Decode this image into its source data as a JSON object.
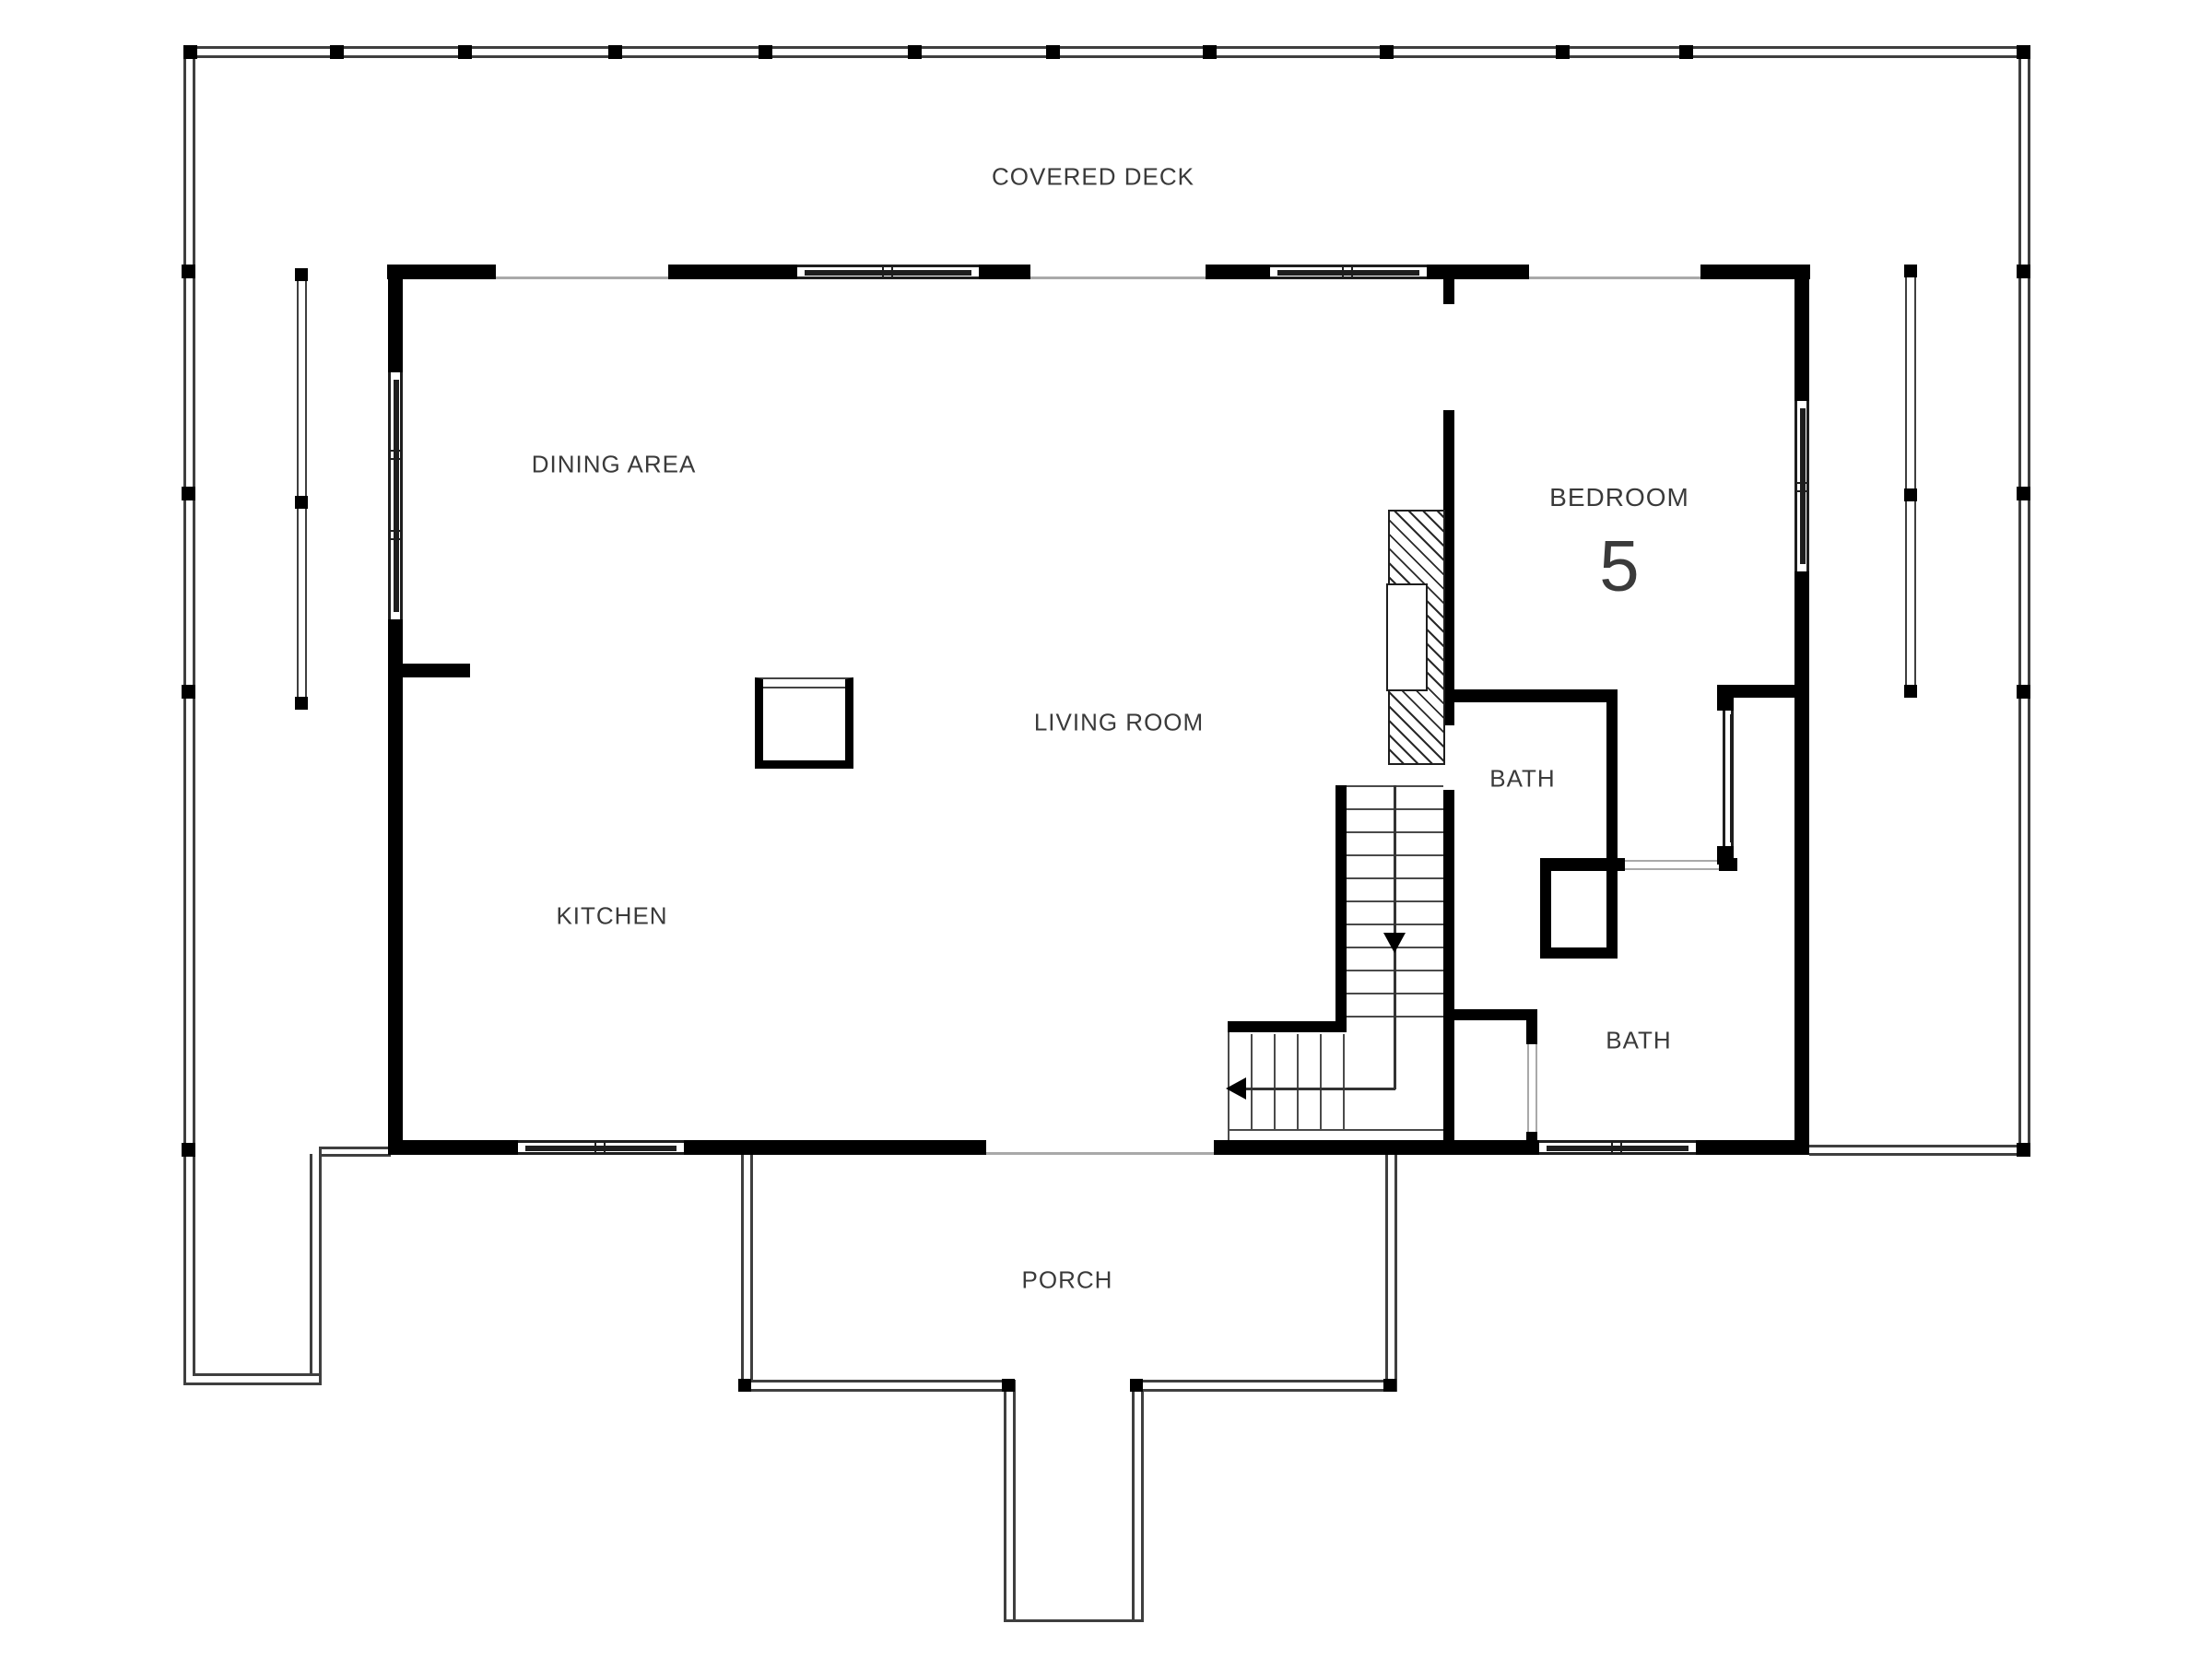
{
  "floor_plan": {
    "labels": {
      "covered_deck": "COVERED DECK",
      "dining_area": "DINING AREA",
      "kitchen": "KITCHEN",
      "living_room": "LIVING ROOM",
      "bedroom": "BEDROOM",
      "bedroom_number": "5",
      "bath_upper": "BATH",
      "bath_lower": "BATH",
      "porch": "PORCH"
    },
    "colors": {
      "wall": "#000000",
      "deck_line": "#3f3f3f",
      "floor_line": "#a9a9a9",
      "text": "#3a3a3a",
      "background": "#ffffff"
    }
  }
}
